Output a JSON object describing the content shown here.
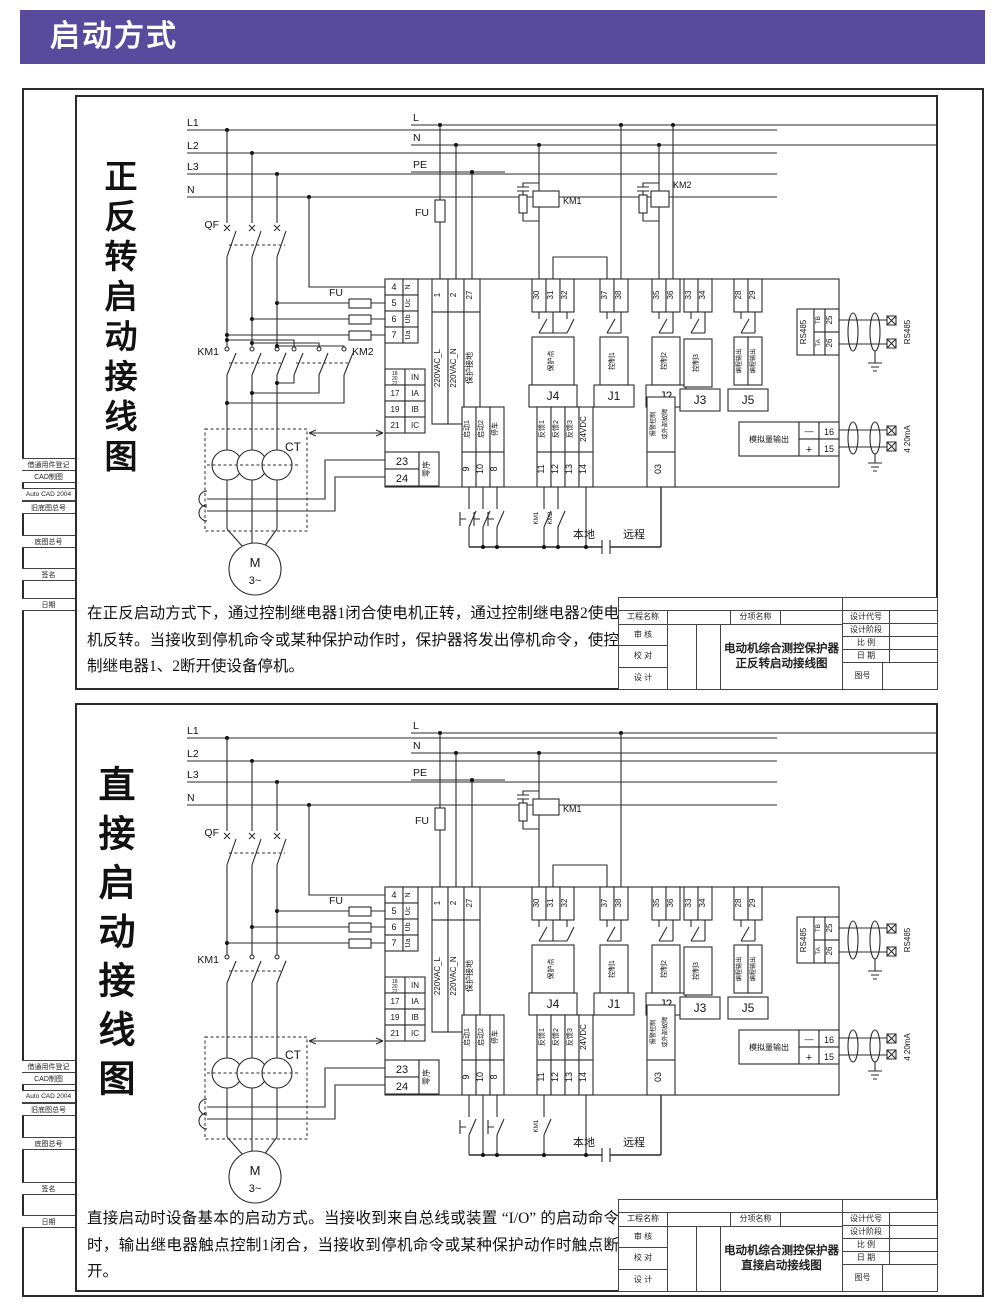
{
  "header": {
    "title": "启动方式"
  },
  "sidebar": {
    "items": [
      "借通用件登记",
      "CAD制图",
      "Auto CAD 2004",
      "旧底图总号",
      "底图总号",
      "签名",
      "日期"
    ]
  },
  "common": {
    "rails_left": [
      "L1",
      "L2",
      "L3",
      "N"
    ],
    "rails_right": [
      "L",
      "N",
      "PE"
    ],
    "qf": "QF",
    "fu": "FU",
    "km1": "KM1",
    "km2": "KM2",
    "ct": "CT",
    "motor": "M",
    "motor_phase": "3~",
    "local_label": "本地",
    "remote_label": "远程",
    "left_terms": [
      {
        "num": "4",
        "label": "N"
      },
      {
        "num": "5",
        "label": "Uc"
      },
      {
        "num": "6",
        "label": "Ub"
      },
      {
        "num": "7",
        "label": "Ua"
      }
    ],
    "power_terms": [
      {
        "num": "1",
        "label": "220VAC_L"
      },
      {
        "num": "2",
        "label": "220VAC_N"
      },
      {
        "num": "27",
        "label": "保护接地"
      }
    ],
    "cur": {
      "in_nums": [
        "18",
        "20",
        "22"
      ],
      "in_label": "IN",
      "rows": [
        {
          "num": "17",
          "label": "IA"
        },
        {
          "num": "19",
          "label": "IB"
        },
        {
          "num": "21",
          "label": "IC"
        }
      ]
    },
    "zero": {
      "n1": "23",
      "n2": "24",
      "label": "零序"
    },
    "relay_groups": [
      {
        "nums": [
          "30",
          "31",
          "32"
        ],
        "label": "保护点",
        "j": "J4"
      },
      {
        "nums": [
          "37",
          "38"
        ],
        "label": "控制1",
        "j": "J1"
      },
      {
        "nums": [
          "35",
          "36"
        ],
        "label": "控制2",
        "j": "J2"
      },
      {
        "nums": [
          "33",
          "34"
        ],
        "label": "控制3",
        "j": "J3"
      },
      {
        "nums": [
          "28",
          "29"
        ],
        "label": "编程输出",
        "label2": "编程输出",
        "j": "J5"
      }
    ],
    "di": [
      {
        "num": "9",
        "label": "启动1"
      },
      {
        "num": "10",
        "label": "启动2"
      },
      {
        "num": "8",
        "label": "停车"
      },
      {
        "num": "11",
        "label": "反馈1"
      },
      {
        "num": "12",
        "label": "反馈2"
      },
      {
        "num": "13",
        "label": "反馈3"
      },
      {
        "num": "14",
        "label": "24VDC"
      }
    ],
    "alarm": {
      "num": "03",
      "line1": "报警控制",
      "line2": "或外部故障"
    },
    "rs485": {
      "title": "RS485",
      "tb": "TB",
      "ta": "TA",
      "n25": "25",
      "n26": "26",
      "ext": "RS485"
    },
    "analog": {
      "label": "模拟量输出",
      "minus": "—",
      "plus": "+",
      "n16": "16",
      "n15": "15",
      "ext": "4 20mA"
    }
  },
  "top": {
    "side_title": "正反转启动接线图",
    "desc": "在正反启动方式下，通过控制继电器1闭合使电机正转，通过控制继电器2使电机反转。当接收到停机命令或某种保护动作时，保护器将发出停机命令，使控制继电器1、2断开使设备停机。",
    "tb1": "电动机综合测控保护器",
    "tb2": "正反转启动接线图"
  },
  "bottom": {
    "side_title": "直接启动接线图",
    "desc": "直接启动时设备基本的启动方式。当接收到来自总线或装置 “I/O” 的启动命令时，输出继电器触点控制1闭合，当接收到停机命令或某种保护动作时触点断开。",
    "tb1": "电动机综合测控保护器",
    "tb2": "直接启动接线图"
  },
  "titleblock": {
    "project": "工程名称",
    "subitem": "分项名称",
    "review": "审  核",
    "proof": "校  对",
    "design": "设  计",
    "code": "设计代号",
    "stage": "设计阶段",
    "scale": "比  例",
    "date": "日  期",
    "fig": "图号"
  },
  "colors": {
    "accent": "#584a9c",
    "line": "#2b2b2b"
  }
}
